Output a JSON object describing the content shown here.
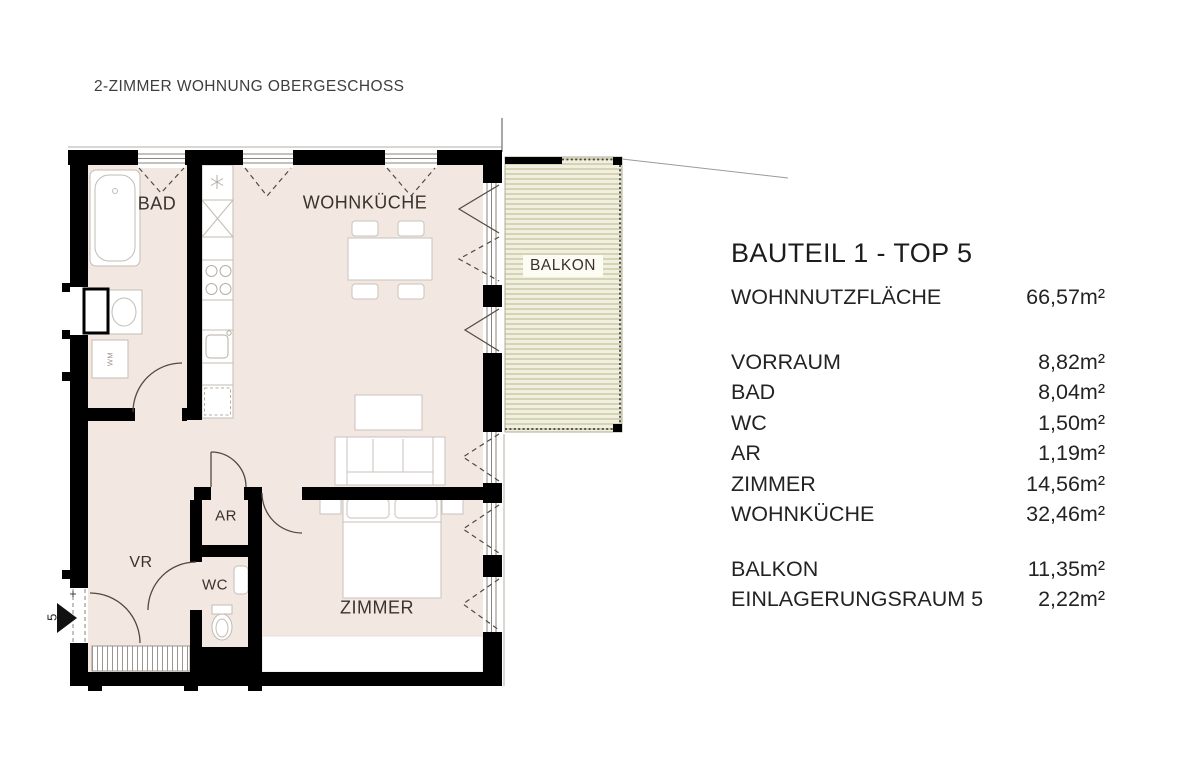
{
  "page": {
    "title": "2-ZIMMER WOHNUNG OBERGESCHOSS"
  },
  "panel": {
    "title": "BAUTEIL 1 - TOP 5",
    "total": {
      "label": "WOHNNUTZFLÄCHE",
      "value": "66,57m²"
    },
    "rooms": [
      {
        "name": "VORRAUM",
        "value": "8,82m²"
      },
      {
        "name": "BAD",
        "value": "8,04m²"
      },
      {
        "name": "WC",
        "value": "1,50m²"
      },
      {
        "name": "AR",
        "value": "1,19m²"
      },
      {
        "name": "ZIMMER",
        "value": "14,56m²"
      },
      {
        "name": "WOHNKÜCHE",
        "value": "32,46m²"
      }
    ],
    "extras": [
      {
        "name": "BALKON",
        "value": "11,35m²"
      },
      {
        "name": "EINLAGERUNGSRAUM 5",
        "value": "2,22m²"
      }
    ]
  },
  "plan": {
    "labels": {
      "bad": "BAD",
      "wohnkueche": "WOHNKÜCHE",
      "balkon": "BALKON",
      "vr": "VR",
      "ar": "AR",
      "wc": "WC",
      "zimmer": "ZIMMER",
      "wm": "WM",
      "entry_number": "5"
    },
    "colors": {
      "wall": "#000000",
      "floor": "#f2e8e1",
      "balcony_light": "#f0efe0",
      "balcony_dark": "#d5d3b3",
      "line": "#54493f"
    }
  }
}
